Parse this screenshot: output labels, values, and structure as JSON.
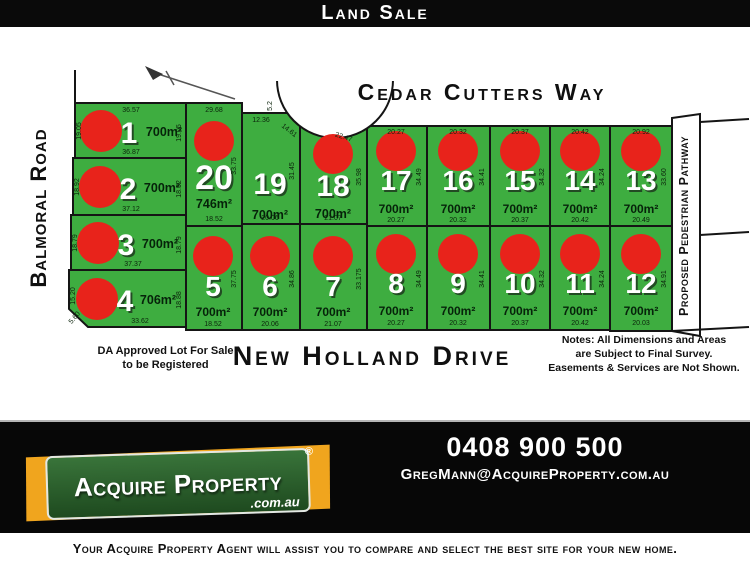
{
  "header": {
    "title": "Land Sale"
  },
  "streets": {
    "top": "Cedar Cutters Way",
    "bottom": "New Holland Drive",
    "left": "Balmoral Road",
    "right": "Proposed Pedestrian Pathway"
  },
  "notes": {
    "da_line1": "DA Approved Lot For Sale",
    "da_line2": "to be Registered",
    "right_line1": "Notes: All Dimensions and Areas",
    "right_line2": "are Subject to Final Survey.",
    "right_line3": "Easements & Services are Not Shown."
  },
  "lots": [
    {
      "number": "1",
      "area": "700m²",
      "red_dot": true,
      "dims": [
        {
          "side": "top",
          "value": "36.57"
        },
        {
          "side": "left",
          "value": "19.05"
        },
        {
          "side": "right",
          "value": "19.05"
        },
        {
          "side": "bottom",
          "value": "36.87"
        }
      ]
    },
    {
      "number": "2",
      "area": "700m²",
      "red_dot": true,
      "dims": [
        {
          "side": "left",
          "value": "18.92"
        },
        {
          "side": "right",
          "value": "18.92"
        },
        {
          "side": "bottom",
          "value": "37.12"
        }
      ]
    },
    {
      "number": "3",
      "area": "700m²",
      "red_dot": true,
      "dims": [
        {
          "side": "left",
          "value": "18.79"
        },
        {
          "side": "right",
          "value": "18.79"
        },
        {
          "side": "bottom",
          "value": "37.37"
        }
      ]
    },
    {
      "number": "4",
      "area": "706m²",
      "red_dot": true,
      "dims": [
        {
          "side": "left",
          "value": "15.20"
        },
        {
          "side": "diagonal",
          "value": "5.60"
        },
        {
          "side": "bottom",
          "value": "33.62"
        },
        {
          "side": "right",
          "value": "18.88"
        }
      ]
    },
    {
      "number": "20",
      "area": "746m²",
      "red_dot": true,
      "dims": [
        {
          "side": "top",
          "value": "29.68"
        },
        {
          "side": "right",
          "value": "33.75"
        },
        {
          "side": "bottom",
          "value": "18.52"
        }
      ]
    },
    {
      "number": "19",
      "area": "700m²",
      "red_dot": false,
      "dims": [
        {
          "side": "top",
          "value": "12.36"
        },
        {
          "side": "step",
          "value": "5.2"
        },
        {
          "side": "diagonal",
          "value": "14.61"
        },
        {
          "side": "right",
          "value": "31.45"
        },
        {
          "side": "bottom",
          "value": "20.06"
        }
      ]
    },
    {
      "number": "18",
      "area": "700m²",
      "red_dot": true,
      "dims": [
        {
          "side": "diagonal",
          "value": "22.47"
        },
        {
          "side": "right",
          "value": "35.98"
        },
        {
          "side": "bottom",
          "value": "21.07"
        }
      ]
    },
    {
      "number": "17",
      "area": "700m²",
      "red_dot": true,
      "dims": [
        {
          "side": "top",
          "value": "20.27"
        },
        {
          "side": "right",
          "value": "34.49"
        },
        {
          "side": "bottom",
          "value": "20.27"
        }
      ]
    },
    {
      "number": "16",
      "area": "700m²",
      "red_dot": true,
      "dims": [
        {
          "side": "top",
          "value": "20.32"
        },
        {
          "side": "right",
          "value": "34.41"
        },
        {
          "side": "bottom",
          "value": "20.32"
        }
      ]
    },
    {
      "number": "15",
      "area": "700m²",
      "red_dot": true,
      "dims": [
        {
          "side": "top",
          "value": "20.37"
        },
        {
          "side": "right",
          "value": "34.32"
        },
        {
          "side": "bottom",
          "value": "20.37"
        }
      ]
    },
    {
      "number": "14",
      "area": "700m²",
      "red_dot": true,
      "dims": [
        {
          "side": "top",
          "value": "20.42"
        },
        {
          "side": "right",
          "value": "34.24"
        },
        {
          "side": "bottom",
          "value": "20.42"
        }
      ]
    },
    {
      "number": "13",
      "area": "700m²",
      "red_dot": true,
      "dims": [
        {
          "side": "top",
          "value": "20.92"
        },
        {
          "side": "right",
          "value": "33.60"
        },
        {
          "side": "bottom",
          "value": "20.49"
        }
      ]
    },
    {
      "number": "5",
      "area": "700m²",
      "red_dot": true,
      "dims": [
        {
          "side": "right",
          "value": "37.75"
        },
        {
          "side": "bottom",
          "value": "18.52"
        }
      ]
    },
    {
      "number": "6",
      "area": "700m²",
      "red_dot": true,
      "dims": [
        {
          "side": "right",
          "value": "34.86"
        },
        {
          "side": "bottom",
          "value": "20.06"
        }
      ]
    },
    {
      "number": "7",
      "area": "700m²",
      "red_dot": true,
      "dims": [
        {
          "side": "right",
          "value": "33.175"
        },
        {
          "side": "bottom",
          "value": "21.07"
        }
      ]
    },
    {
      "number": "8",
      "area": "700m²",
      "red_dot": true,
      "dims": [
        {
          "side": "right",
          "value": "34.49"
        },
        {
          "side": "bottom",
          "value": "20.27"
        }
      ]
    },
    {
      "number": "9",
      "area": "700m²",
      "red_dot": true,
      "dims": [
        {
          "side": "right",
          "value": "34.41"
        },
        {
          "side": "bottom",
          "value": "20.32"
        }
      ]
    },
    {
      "number": "10",
      "area": "700m²",
      "red_dot": true,
      "dims": [
        {
          "side": "right",
          "value": "34.32"
        },
        {
          "side": "bottom",
          "value": "20.37"
        }
      ]
    },
    {
      "number": "11",
      "area": "700m²",
      "red_dot": true,
      "dims": [
        {
          "side": "right",
          "value": "34.24"
        },
        {
          "side": "bottom",
          "value": "20.42"
        }
      ]
    },
    {
      "number": "12",
      "area": "700m²",
      "red_dot": true,
      "dims": [
        {
          "side": "right",
          "value": "34.91"
        },
        {
          "side": "bottom",
          "value": "20.03"
        }
      ]
    }
  ],
  "footer": {
    "phone": "0408 900 500",
    "email": "GregMann@AcquireProperty.com.au",
    "logo_name": "Acquire Property",
    "logo_reg": "®",
    "logo_domain": ".com.au"
  },
  "tagline": "Your Acquire Property Agent will assist you to compare and select the best site for your new home.",
  "colors": {
    "lot_green": "#3EAD40",
    "dot_red": "#E8231B",
    "logo_yellow": "#F0A51E",
    "logo_green": "#2B5C2B",
    "header_black": "#0a0a0a"
  }
}
